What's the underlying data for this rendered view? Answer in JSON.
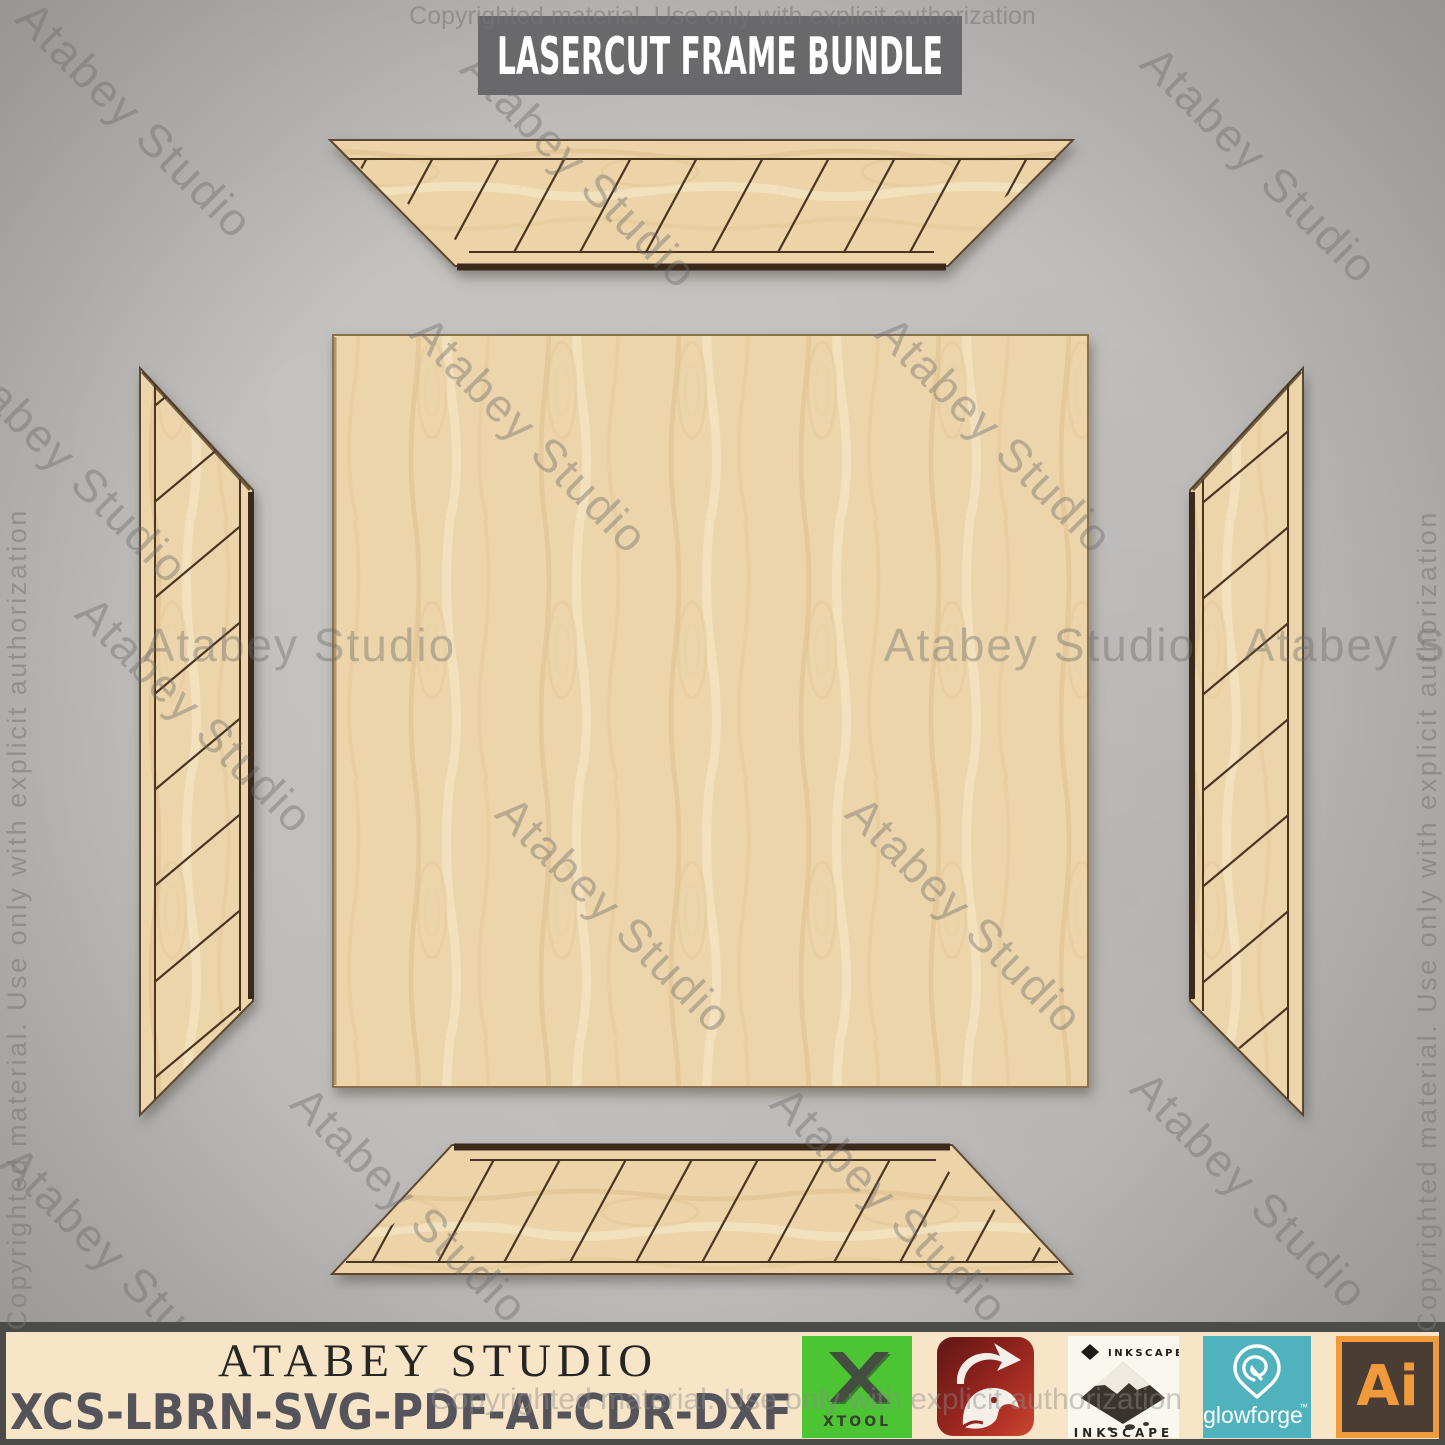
{
  "title": "LASERCUT FRAME BUNDLE",
  "watermarks": {
    "copyright": "Copyrighted material. Use only with explicit authorization",
    "studio": "Atabey Studio"
  },
  "scene": {
    "pieces": [
      "frame-side-top",
      "frame-side-left",
      "frame-side-right",
      "frame-side-bottom",
      "backer-panel"
    ],
    "wood_color": "#edd5ab",
    "engrave_line_color": "#4a3522",
    "cut_edge_color": "#5d4730",
    "background_color": "#c0bebc"
  },
  "banner": {
    "studio_name": "ATABEY STUDIO",
    "formats": "XCS-LBRN-SVG-PDF-AI-CDR-DXF",
    "background": "#f8e5c7",
    "border_color": "#4b4b49",
    "logos": [
      {
        "name": "xtool",
        "label": "XTOOL",
        "color": "#4cc434"
      },
      {
        "name": "lightburn",
        "label": "",
        "color": "#a32a22"
      },
      {
        "name": "inkscape",
        "label": "INKSCAPE",
        "color": "#faf7ee"
      },
      {
        "name": "glowforge",
        "label": "glowforge",
        "tm": "™",
        "color": "#4fb2bc"
      },
      {
        "name": "adobe-illustrator",
        "label": "Ai",
        "color": "#f09a3b"
      }
    ]
  }
}
